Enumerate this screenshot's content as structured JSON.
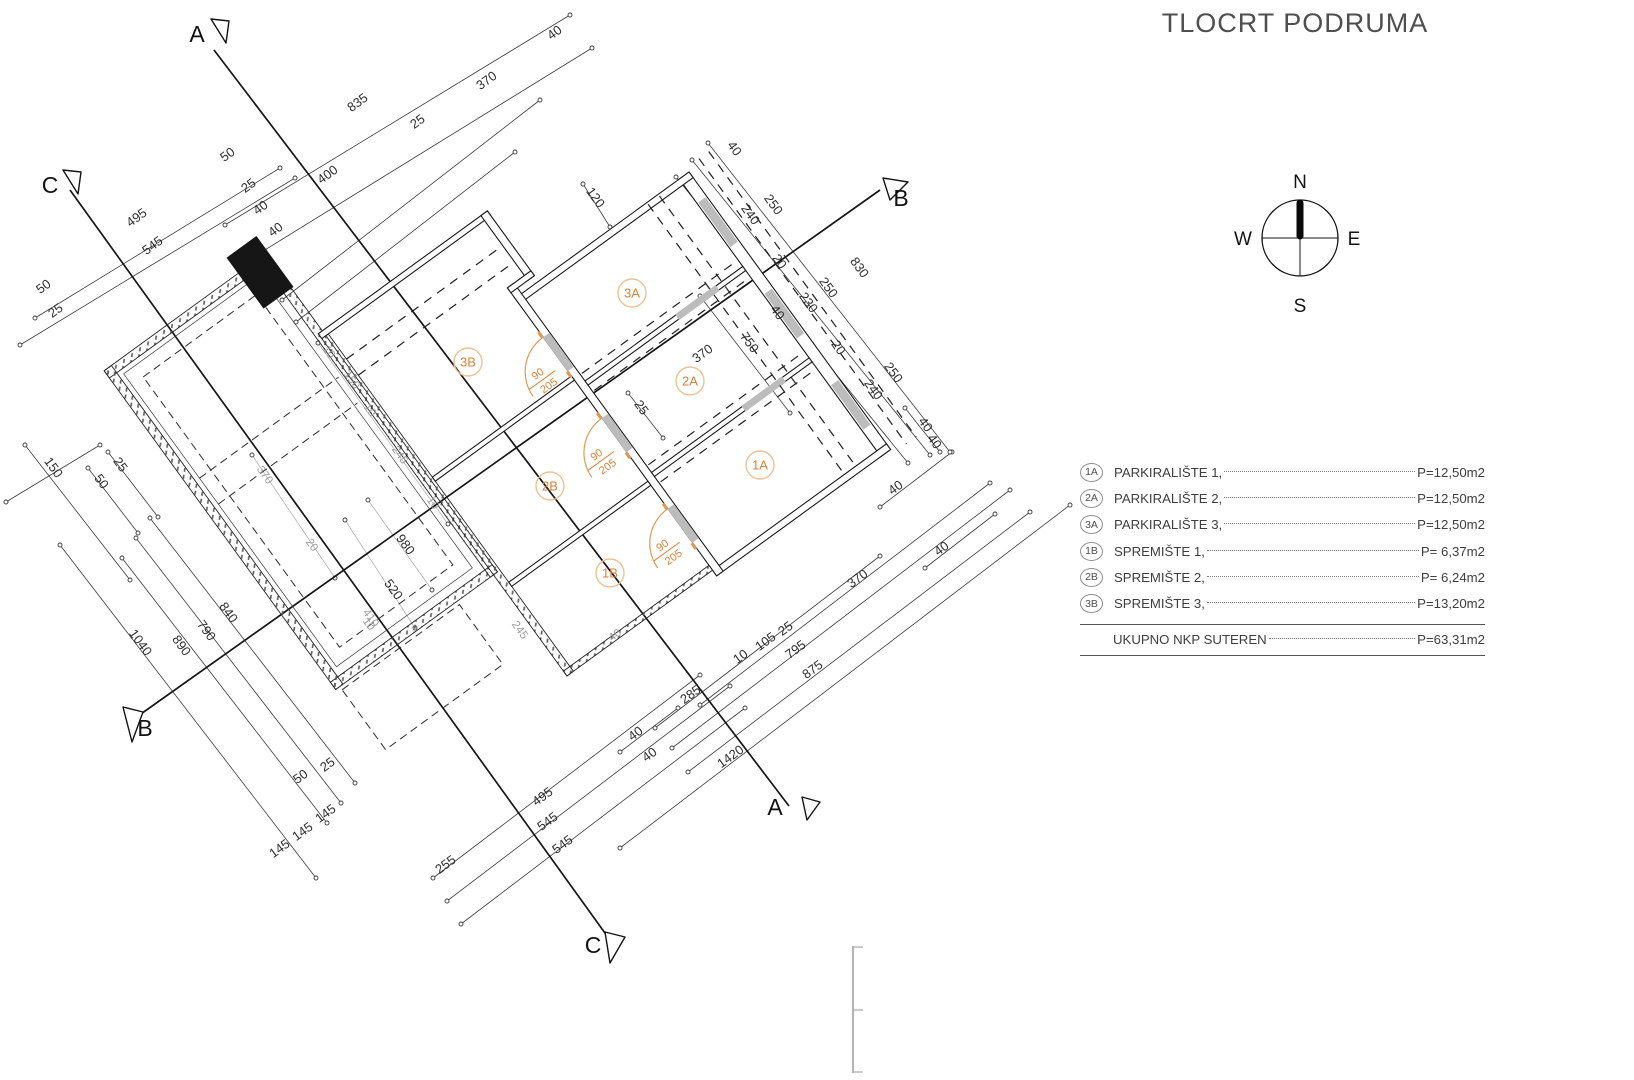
{
  "title": "TLOCRT PODRUMA",
  "compass": {
    "north": "N",
    "east": "E",
    "south": "S",
    "west": "W"
  },
  "legend": {
    "rows": [
      {
        "badge": "1A",
        "name": "PARKIRALIŠTE 1,",
        "value": "P=12,50m2"
      },
      {
        "badge": "2A",
        "name": "PARKIRALIŠTE 2,",
        "value": "P=12,50m2"
      },
      {
        "badge": "3A",
        "name": "PARKIRALIŠTE 3,",
        "value": "P=12,50m2"
      },
      {
        "badge": "1B",
        "name": "SPREMIŠTE 1,",
        "value": "P=  6,37m2"
      },
      {
        "badge": "2B",
        "name": "SPREMIŠTE 2,",
        "value": "P=  6,24m2"
      },
      {
        "badge": "3B",
        "name": "SPREMIŠTE 3,",
        "value": "P=13,20m2"
      }
    ],
    "total_name": "UKUPNO NKP SUTEREN",
    "total_value": "P=63,31m2"
  },
  "plan": {
    "rooms": [
      {
        "id": "1A",
        "x": 760,
        "y": 465
      },
      {
        "id": "2A",
        "x": 690,
        "y": 381
      },
      {
        "id": "3A",
        "x": 632,
        "y": 293
      },
      {
        "id": "1B",
        "x": 610,
        "y": 573
      },
      {
        "id": "2B",
        "x": 550,
        "y": 486
      },
      {
        "id": "3B",
        "x": 468,
        "y": 362
      }
    ],
    "doors": [
      {
        "top": "90",
        "bottom": "205",
        "lx": -216,
        "ly": 90
      },
      {
        "top": "90",
        "bottom": "205",
        "lx": -216,
        "ly": 190
      },
      {
        "top": "90",
        "bottom": "205",
        "lx": -216,
        "ly": 302
      }
    ],
    "sections": [
      {
        "t": "A",
        "x": 197,
        "y": 42
      },
      {
        "t": "C",
        "x": 50,
        "y": 193
      },
      {
        "t": "B",
        "x": 901,
        "y": 206
      },
      {
        "t": "B",
        "x": 145,
        "y": 736
      },
      {
        "t": "A",
        "x": 775,
        "y": 815
      },
      {
        "t": "C",
        "x": 593,
        "y": 953
      }
    ],
    "dims": [
      {
        "t": "835",
        "x": 360,
        "y": 106,
        "r": -36
      },
      {
        "t": "370",
        "x": 489,
        "y": 84,
        "r": -36
      },
      {
        "t": "40",
        "x": 557,
        "y": 36,
        "r": -36
      },
      {
        "t": "25",
        "x": 420,
        "y": 125,
        "r": -36
      },
      {
        "t": "400",
        "x": 330,
        "y": 178,
        "r": -36
      },
      {
        "t": "50",
        "x": 230,
        "y": 158,
        "r": -36
      },
      {
        "t": "25",
        "x": 251,
        "y": 189,
        "r": -36
      },
      {
        "t": "40",
        "x": 263,
        "y": 211,
        "r": -36
      },
      {
        "t": "40",
        "x": 278,
        "y": 233,
        "r": -36
      },
      {
        "t": "495",
        "x": 139,
        "y": 221,
        "r": -36
      },
      {
        "t": "545",
        "x": 155,
        "y": 249,
        "r": -36
      },
      {
        "t": "50",
        "x": 46,
        "y": 290,
        "r": -36
      },
      {
        "t": "25",
        "x": 58,
        "y": 314,
        "r": -36
      },
      {
        "t": "120",
        "x": 592,
        "y": 200,
        "r": 54
      },
      {
        "t": "40",
        "x": 731,
        "y": 151,
        "r": 54
      },
      {
        "t": "250",
        "x": 770,
        "y": 207,
        "r": 54
      },
      {
        "t": "240",
        "x": 747,
        "y": 217,
        "r": 54
      },
      {
        "t": "20",
        "x": 776,
        "y": 264,
        "r": 54
      },
      {
        "t": "830",
        "x": 856,
        "y": 270,
        "r": 54
      },
      {
        "t": "250",
        "x": 825,
        "y": 290,
        "r": 54
      },
      {
        "t": "230",
        "x": 805,
        "y": 305,
        "r": 54
      },
      {
        "t": "40",
        "x": 774,
        "y": 315,
        "r": 54
      },
      {
        "t": "750",
        "x": 746,
        "y": 345,
        "r": 54
      },
      {
        "t": "20",
        "x": 835,
        "y": 350,
        "r": 54
      },
      {
        "t": "250",
        "x": 890,
        "y": 375,
        "r": 54
      },
      {
        "t": "240",
        "x": 870,
        "y": 392,
        "r": 54
      },
      {
        "t": "40",
        "x": 922,
        "y": 427,
        "r": 54
      },
      {
        "t": "40",
        "x": 931,
        "y": 444,
        "r": 54
      },
      {
        "t": "25",
        "x": 638,
        "y": 410,
        "r": 54
      },
      {
        "t": "370",
        "x": 705,
        "y": 357,
        "r": -36
      },
      {
        "t": "40",
        "x": 898,
        "y": 491,
        "r": -36
      },
      {
        "t": "40",
        "x": 944,
        "y": 552,
        "r": -36
      },
      {
        "t": "10",
        "x": 326,
        "y": 354,
        "r": 54,
        "c": "g"
      },
      {
        "t": "150",
        "x": 349,
        "y": 382,
        "r": 54,
        "c": "g"
      },
      {
        "t": "10",
        "x": 367,
        "y": 412,
        "r": 54,
        "c": "g"
      },
      {
        "t": "245",
        "x": 397,
        "y": 457,
        "r": 54,
        "c": "g"
      },
      {
        "t": "10",
        "x": 430,
        "y": 505,
        "r": 54,
        "c": "g"
      },
      {
        "t": "370",
        "x": 262,
        "y": 477,
        "r": 54,
        "c": "g"
      },
      {
        "t": "20",
        "x": 309,
        "y": 547,
        "r": 54,
        "c": "g"
      },
      {
        "t": "980",
        "x": 402,
        "y": 547,
        "r": 54
      },
      {
        "t": "520",
        "x": 390,
        "y": 592,
        "r": 54
      },
      {
        "t": "410",
        "x": 368,
        "y": 620,
        "r": 54,
        "c": "g"
      },
      {
        "t": "150",
        "x": 50,
        "y": 470,
        "r": 54
      },
      {
        "t": "25",
        "x": 117,
        "y": 467,
        "r": 54
      },
      {
        "t": "50",
        "x": 98,
        "y": 484,
        "r": 54
      },
      {
        "t": "840",
        "x": 225,
        "y": 615,
        "r": 54
      },
      {
        "t": "790",
        "x": 203,
        "y": 633,
        "r": 54
      },
      {
        "t": "890",
        "x": 178,
        "y": 648,
        "r": 54
      },
      {
        "t": "1040",
        "x": 137,
        "y": 645,
        "r": 54
      },
      {
        "t": "25",
        "x": 330,
        "y": 768,
        "r": -36
      },
      {
        "t": "50",
        "x": 303,
        "y": 780,
        "r": -36
      },
      {
        "t": "145",
        "x": 328,
        "y": 817,
        "r": -36
      },
      {
        "t": "145",
        "x": 305,
        "y": 835,
        "r": -36
      },
      {
        "t": "145",
        "x": 282,
        "y": 852,
        "r": -36
      },
      {
        "t": "255",
        "x": 448,
        "y": 868,
        "r": -36
      },
      {
        "t": "495",
        "x": 545,
        "y": 800,
        "r": -36
      },
      {
        "t": "545",
        "x": 550,
        "y": 825,
        "r": -36
      },
      {
        "t": "545",
        "x": 565,
        "y": 848,
        "r": -36
      },
      {
        "t": "40",
        "x": 638,
        "y": 737,
        "r": -36
      },
      {
        "t": "40",
        "x": 652,
        "y": 758,
        "r": -36
      },
      {
        "t": "285",
        "x": 693,
        "y": 698,
        "r": -36
      },
      {
        "t": "10",
        "x": 743,
        "y": 660,
        "r": -36
      },
      {
        "t": "105",
        "x": 768,
        "y": 645,
        "r": -36
      },
      {
        "t": "25",
        "x": 788,
        "y": 632,
        "r": -36
      },
      {
        "t": "795",
        "x": 798,
        "y": 653,
        "r": -36
      },
      {
        "t": "875",
        "x": 815,
        "y": 673,
        "r": -36
      },
      {
        "t": "1420",
        "x": 733,
        "y": 760,
        "r": -36
      },
      {
        "t": "370",
        "x": 860,
        "y": 582,
        "r": -36
      },
      {
        "t": "40",
        "x": 617,
        "y": 638,
        "r": -36,
        "c": "g"
      },
      {
        "t": "10",
        "x": 366,
        "y": 626,
        "r": 54,
        "c": "g"
      },
      {
        "t": "245",
        "x": 517,
        "y": 632,
        "r": 54,
        "c": "g"
      }
    ]
  },
  "colors": {
    "accent_orange": "#d9813b",
    "ink": "#1a1a1a",
    "dim_gray": "#9d9d9d",
    "opening_gray": "#bcbcbc",
    "fragment_gray": "#b5b5b5"
  }
}
